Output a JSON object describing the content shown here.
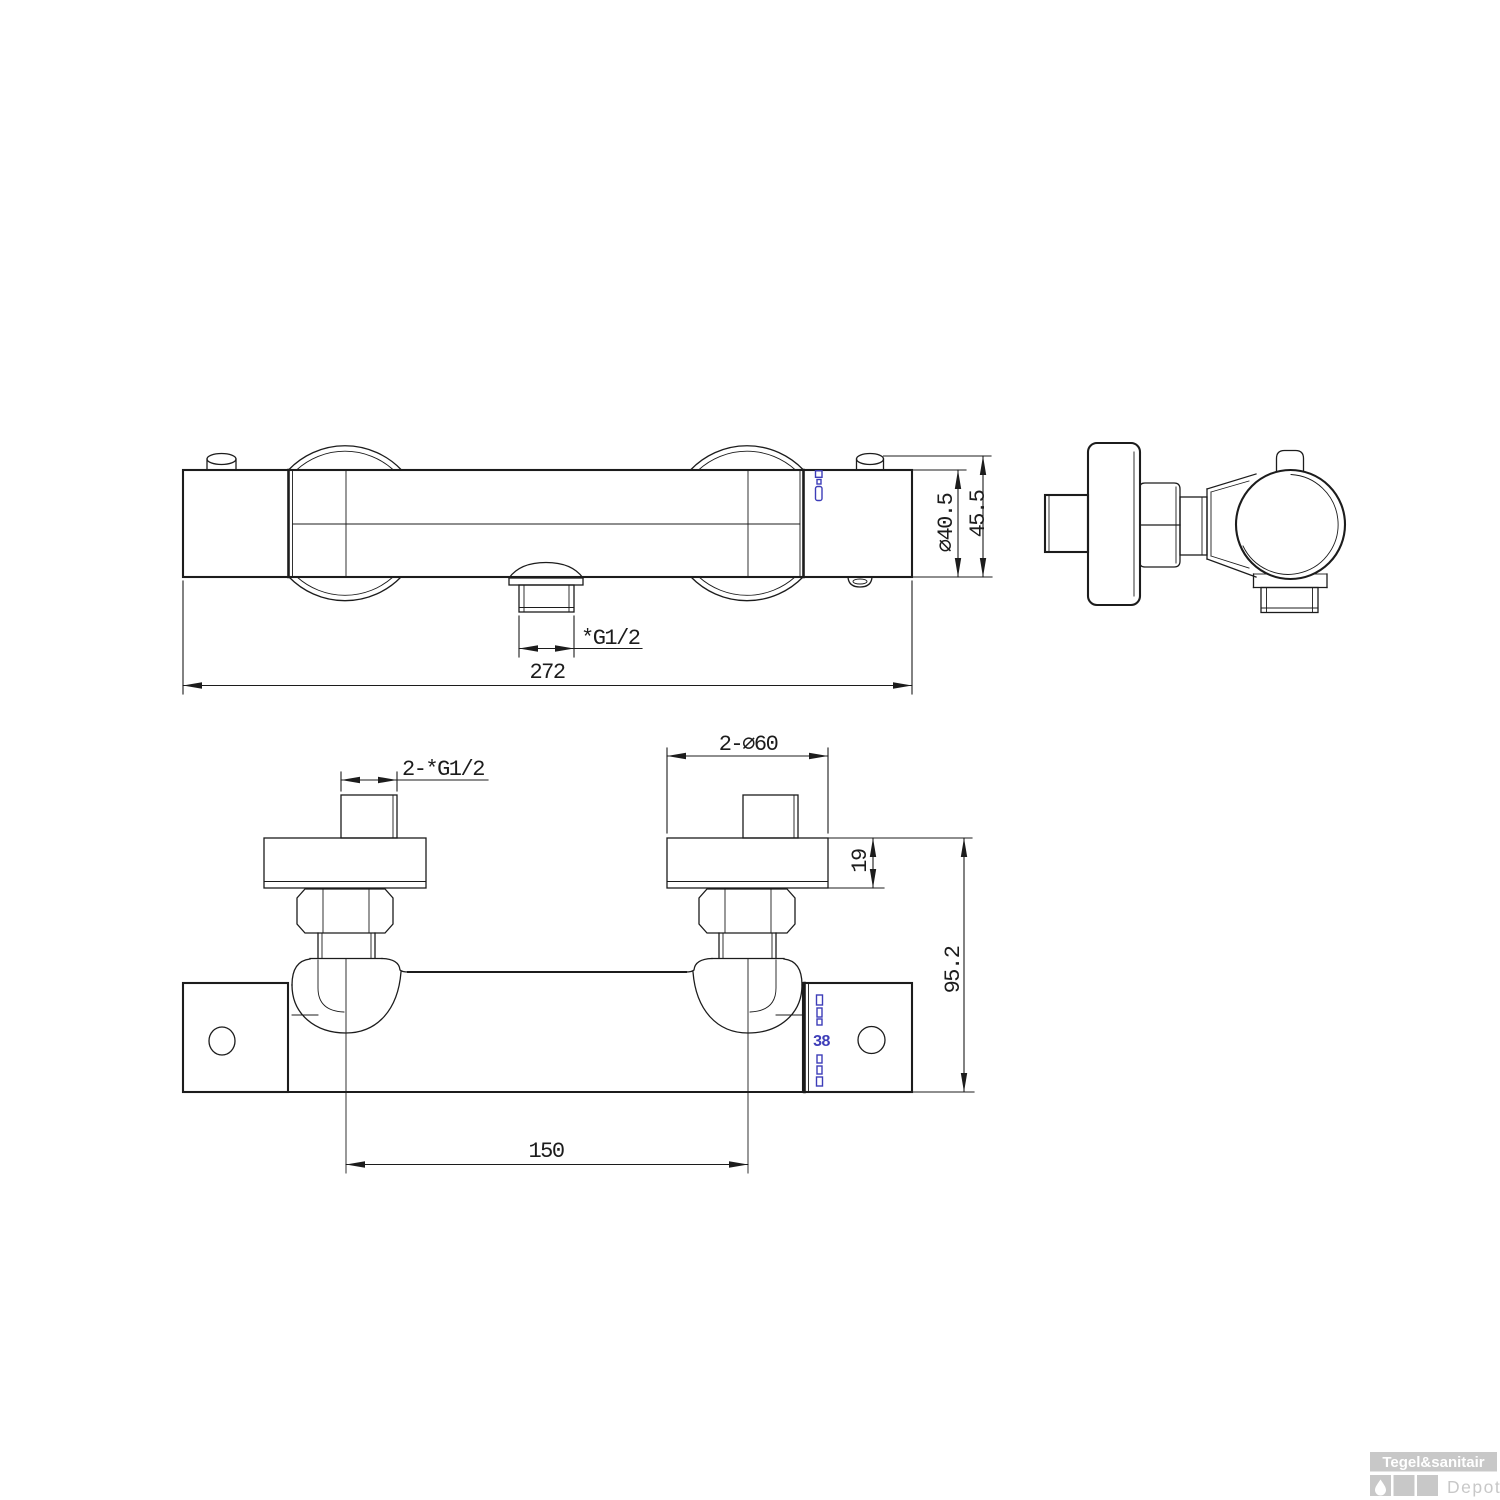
{
  "front_view": {
    "outlet_thread_label": "*G1/2",
    "overall_width": "272",
    "body_diameter": "∅40.5",
    "body_height": "45.5"
  },
  "top_view": {
    "inlet_thread_label": "2-*G1/2",
    "escutcheon_diameter": "2-∅60",
    "escutcheon_thickness": "19",
    "wall_depth": "95.2",
    "inlet_spacing": "150",
    "temperature_stop": "38"
  },
  "watermark": {
    "brand": "Tegel&sanitair",
    "sub_brand": "Depot"
  },
  "icons": {
    "watermark_square_icon": "water-drop"
  },
  "colors": {
    "line": "#1c1c1c",
    "scale_blue": "#3d3db8",
    "watermark_gray": "#c8c8c8",
    "background": "#ffffff"
  }
}
